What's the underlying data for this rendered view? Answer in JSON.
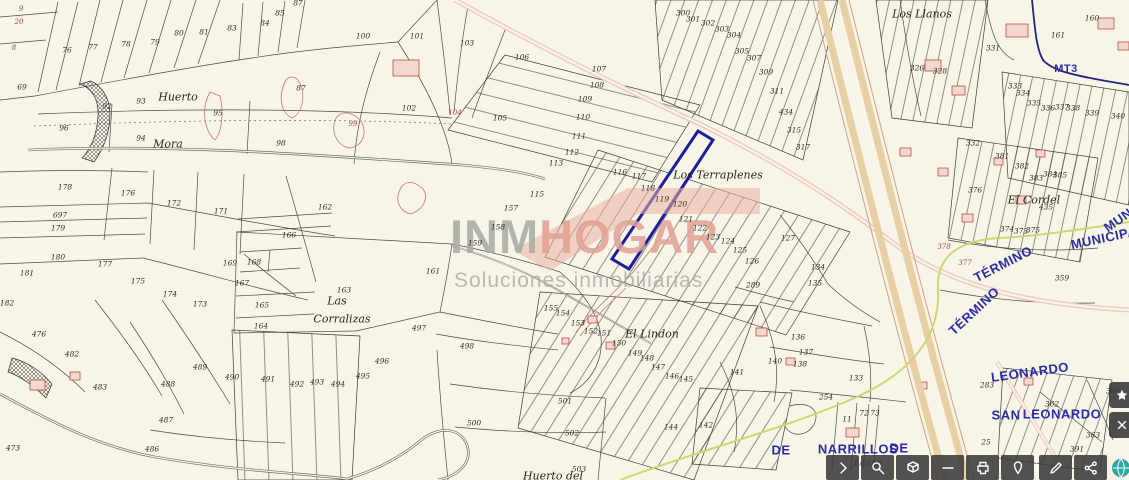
{
  "watermark": {
    "part1": "INM",
    "part2": "HOGAR",
    "subtitle": "Soluciones inmobiliarias",
    "color_gray": "#a6aba3",
    "color_salmon": "#e2a094",
    "roof_color": "#e8b0a4"
  },
  "map": {
    "colors": {
      "background": "#f8f5e8",
      "parcel_line": "#3d3b36",
      "highlight": "#1c1c9e",
      "municipal_boundary": "#24247c",
      "road_pink": "#ddA298",
      "highway_tan": "#e9cfa6",
      "greenway": "#ccd86f",
      "blue_text": "#2b2da8",
      "red_detail": "#b0453c"
    },
    "labels": [
      {
        "t": "9",
        "x": 21,
        "y": 9,
        "c": "r"
      },
      {
        "t": "20",
        "x": 19,
        "y": 22,
        "c": "r"
      },
      {
        "t": "8",
        "x": 14,
        "y": 48,
        "c": "r"
      },
      {
        "t": "69",
        "x": 22,
        "y": 87,
        "c": "n"
      },
      {
        "t": "76",
        "x": 67,
        "y": 50,
        "c": "n"
      },
      {
        "t": "77",
        "x": 93,
        "y": 47,
        "c": "n"
      },
      {
        "t": "78",
        "x": 126,
        "y": 44,
        "c": "n"
      },
      {
        "t": "79",
        "x": 155,
        "y": 42,
        "c": "n"
      },
      {
        "t": "80",
        "x": 179,
        "y": 33,
        "c": "n"
      },
      {
        "t": "81",
        "x": 204,
        "y": 32,
        "c": "n"
      },
      {
        "t": "83",
        "x": 232,
        "y": 28,
        "c": "n"
      },
      {
        "t": "84",
        "x": 265,
        "y": 23,
        "c": "n"
      },
      {
        "t": "85",
        "x": 280,
        "y": 13,
        "c": "n"
      },
      {
        "t": "87",
        "x": 298,
        "y": 3,
        "c": "n"
      },
      {
        "t": "96",
        "x": 64,
        "y": 128,
        "c": "n"
      },
      {
        "t": "92",
        "x": 107,
        "y": 106,
        "c": "n"
      },
      {
        "t": "93",
        "x": 141,
        "y": 101,
        "c": "n"
      },
      {
        "t": "94",
        "x": 141,
        "y": 138,
        "c": "n"
      },
      {
        "t": "95",
        "x": 218,
        "y": 113,
        "c": "n"
      },
      {
        "t": "87",
        "x": 301,
        "y": 88,
        "c": "n"
      },
      {
        "t": "98",
        "x": 281,
        "y": 143,
        "c": "n"
      },
      {
        "t": "99",
        "x": 353,
        "y": 124,
        "c": "r"
      },
      {
        "t": "100",
        "x": 363,
        "y": 36,
        "c": "n"
      },
      {
        "t": "101",
        "x": 417,
        "y": 36,
        "c": "n"
      },
      {
        "t": "102",
        "x": 409,
        "y": 108,
        "c": "n"
      },
      {
        "t": "103",
        "x": 467,
        "y": 43,
        "c": "n"
      },
      {
        "t": "104",
        "x": 455,
        "y": 113,
        "c": "r"
      },
      {
        "t": "105",
        "x": 500,
        "y": 118,
        "c": "n"
      },
      {
        "t": "106",
        "x": 522,
        "y": 57,
        "c": "n"
      },
      {
        "t": "107",
        "x": 599,
        "y": 69,
        "c": "n"
      },
      {
        "t": "108",
        "x": 597,
        "y": 85,
        "c": "n"
      },
      {
        "t": "109",
        "x": 585,
        "y": 99,
        "c": "n"
      },
      {
        "t": "110",
        "x": 583,
        "y": 117,
        "c": "n"
      },
      {
        "t": "111",
        "x": 579,
        "y": 136,
        "c": "n"
      },
      {
        "t": "112",
        "x": 572,
        "y": 152,
        "c": "n"
      },
      {
        "t": "113",
        "x": 556,
        "y": 163,
        "c": "n"
      },
      {
        "t": "115",
        "x": 537,
        "y": 194,
        "c": "n"
      },
      {
        "t": "157",
        "x": 511,
        "y": 208,
        "c": "n"
      },
      {
        "t": "158",
        "x": 498,
        "y": 227,
        "c": "n"
      },
      {
        "t": "159",
        "x": 475,
        "y": 243,
        "c": "n"
      },
      {
        "t": "162",
        "x": 325,
        "y": 207,
        "c": "n"
      },
      {
        "t": "116",
        "x": 620,
        "y": 172,
        "c": "n"
      },
      {
        "t": "117",
        "x": 639,
        "y": 176,
        "c": "n"
      },
      {
        "t": "118",
        "x": 648,
        "y": 188,
        "c": "n"
      },
      {
        "t": "119",
        "x": 662,
        "y": 199,
        "c": "n"
      },
      {
        "t": "120",
        "x": 680,
        "y": 204,
        "c": "n"
      },
      {
        "t": "121",
        "x": 686,
        "y": 219,
        "c": "n"
      },
      {
        "t": "122",
        "x": 700,
        "y": 228,
        "c": "n"
      },
      {
        "t": "123",
        "x": 713,
        "y": 237,
        "c": "n"
      },
      {
        "t": "124",
        "x": 728,
        "y": 241,
        "c": "n"
      },
      {
        "t": "125",
        "x": 740,
        "y": 250,
        "c": "n"
      },
      {
        "t": "126",
        "x": 752,
        "y": 261,
        "c": "n"
      },
      {
        "t": "127",
        "x": 788,
        "y": 238,
        "c": "n"
      },
      {
        "t": "134",
        "x": 818,
        "y": 267,
        "c": "n"
      },
      {
        "t": "135",
        "x": 815,
        "y": 283,
        "c": "n"
      },
      {
        "t": "289",
        "x": 753,
        "y": 285,
        "c": "n"
      },
      {
        "t": "136",
        "x": 798,
        "y": 337,
        "c": "n"
      },
      {
        "t": "137",
        "x": 806,
        "y": 352,
        "c": "n"
      },
      {
        "t": "138",
        "x": 800,
        "y": 364,
        "c": "n"
      },
      {
        "t": "133",
        "x": 856,
        "y": 378,
        "c": "n"
      },
      {
        "t": "300",
        "x": 683,
        "y": 13,
        "c": "n"
      },
      {
        "t": "301",
        "x": 693,
        "y": 19,
        "c": "n"
      },
      {
        "t": "302",
        "x": 708,
        "y": 23,
        "c": "n"
      },
      {
        "t": "303",
        "x": 722,
        "y": 29,
        "c": "n"
      },
      {
        "t": "304",
        "x": 734,
        "y": 35,
        "c": "n"
      },
      {
        "t": "305",
        "x": 742,
        "y": 51,
        "c": "n"
      },
      {
        "t": "307",
        "x": 754,
        "y": 58,
        "c": "n"
      },
      {
        "t": "309",
        "x": 766,
        "y": 72,
        "c": "n"
      },
      {
        "t": "311",
        "x": 777,
        "y": 91,
        "c": "n"
      },
      {
        "t": "434",
        "x": 786,
        "y": 112,
        "c": "n"
      },
      {
        "t": "315",
        "x": 794,
        "y": 130,
        "c": "n"
      },
      {
        "t": "317",
        "x": 803,
        "y": 147,
        "c": "n"
      },
      {
        "t": "326",
        "x": 917,
        "y": 68,
        "c": "n"
      },
      {
        "t": "328",
        "x": 940,
        "y": 71,
        "c": "n"
      },
      {
        "t": "331",
        "x": 993,
        "y": 48,
        "c": "n"
      },
      {
        "t": "160",
        "x": 1092,
        "y": 18,
        "c": "n"
      },
      {
        "t": "161",
        "x": 1058,
        "y": 35,
        "c": "n"
      },
      {
        "t": "333",
        "x": 1015,
        "y": 86,
        "c": "n"
      },
      {
        "t": "334",
        "x": 1023,
        "y": 93,
        "c": "n"
      },
      {
        "t": "335",
        "x": 1034,
        "y": 103,
        "c": "n"
      },
      {
        "t": "336",
        "x": 1048,
        "y": 108,
        "c": "n"
      },
      {
        "t": "337",
        "x": 1062,
        "y": 107,
        "c": "n"
      },
      {
        "t": "338",
        "x": 1073,
        "y": 108,
        "c": "n"
      },
      {
        "t": "339",
        "x": 1092,
        "y": 113,
        "c": "n"
      },
      {
        "t": "340",
        "x": 1118,
        "y": 116,
        "c": "n"
      },
      {
        "t": "332",
        "x": 973,
        "y": 143,
        "c": "n"
      },
      {
        "t": "381",
        "x": 1002,
        "y": 156,
        "c": "n"
      },
      {
        "t": "382",
        "x": 1022,
        "y": 166,
        "c": "n"
      },
      {
        "t": "383",
        "x": 1036,
        "y": 178,
        "c": "n"
      },
      {
        "t": "384",
        "x": 1050,
        "y": 174,
        "c": "n"
      },
      {
        "t": "385",
        "x": 1060,
        "y": 175,
        "c": "n"
      },
      {
        "t": "376",
        "x": 975,
        "y": 190,
        "c": "n"
      },
      {
        "t": "435",
        "x": 1046,
        "y": 207,
        "c": "n"
      },
      {
        "t": "374",
        "x": 1007,
        "y": 229,
        "c": "n"
      },
      {
        "t": "373",
        "x": 1021,
        "y": 231,
        "c": "n"
      },
      {
        "t": "375",
        "x": 1033,
        "y": 230,
        "c": "n"
      },
      {
        "t": "359",
        "x": 1062,
        "y": 278,
        "c": "n"
      },
      {
        "t": "378",
        "x": 944,
        "y": 247,
        "c": "r"
      },
      {
        "t": "377",
        "x": 965,
        "y": 263,
        "c": "r"
      },
      {
        "t": "178",
        "x": 65,
        "y": 187,
        "c": "n"
      },
      {
        "t": "176",
        "x": 128,
        "y": 193,
        "c": "n"
      },
      {
        "t": "172",
        "x": 174,
        "y": 203,
        "c": "n"
      },
      {
        "t": "171",
        "x": 221,
        "y": 211,
        "c": "n"
      },
      {
        "t": "697",
        "x": 60,
        "y": 215,
        "c": "n"
      },
      {
        "t": "179",
        "x": 58,
        "y": 228,
        "c": "n"
      },
      {
        "t": "180",
        "x": 58,
        "y": 257,
        "c": "n"
      },
      {
        "t": "181",
        "x": 27,
        "y": 273,
        "c": "n"
      },
      {
        "t": "182",
        "x": 7,
        "y": 303,
        "c": "n"
      },
      {
        "t": "177",
        "x": 105,
        "y": 264,
        "c": "n"
      },
      {
        "t": "175",
        "x": 138,
        "y": 281,
        "c": "n"
      },
      {
        "t": "174",
        "x": 170,
        "y": 294,
        "c": "n"
      },
      {
        "t": "173",
        "x": 200,
        "y": 304,
        "c": "n"
      },
      {
        "t": "169",
        "x": 230,
        "y": 263,
        "c": "n"
      },
      {
        "t": "168",
        "x": 254,
        "y": 262,
        "c": "n"
      },
      {
        "t": "167",
        "x": 242,
        "y": 283,
        "c": "n"
      },
      {
        "t": "166",
        "x": 289,
        "y": 235,
        "c": "n"
      },
      {
        "t": "165",
        "x": 262,
        "y": 305,
        "c": "n"
      },
      {
        "t": "164",
        "x": 261,
        "y": 326,
        "c": "n"
      },
      {
        "t": "163",
        "x": 344,
        "y": 290,
        "c": "n"
      },
      {
        "t": "161",
        "x": 433,
        "y": 271,
        "c": "n"
      },
      {
        "t": "476",
        "x": 39,
        "y": 334,
        "c": "n"
      },
      {
        "t": "482",
        "x": 72,
        "y": 354,
        "c": "n"
      },
      {
        "t": "483",
        "x": 100,
        "y": 387,
        "c": "n"
      },
      {
        "t": "473",
        "x": 13,
        "y": 448,
        "c": "n"
      },
      {
        "t": "486",
        "x": 152,
        "y": 449,
        "c": "n"
      },
      {
        "t": "487",
        "x": 166,
        "y": 420,
        "c": "n"
      },
      {
        "t": "488",
        "x": 168,
        "y": 384,
        "c": "n"
      },
      {
        "t": "489",
        "x": 200,
        "y": 367,
        "c": "n"
      },
      {
        "t": "490",
        "x": 232,
        "y": 377,
        "c": "n"
      },
      {
        "t": "491",
        "x": 268,
        "y": 379,
        "c": "n"
      },
      {
        "t": "492",
        "x": 297,
        "y": 384,
        "c": "n"
      },
      {
        "t": "493",
        "x": 317,
        "y": 382,
        "c": "n"
      },
      {
        "t": "494",
        "x": 338,
        "y": 384,
        "c": "n"
      },
      {
        "t": "495",
        "x": 363,
        "y": 376,
        "c": "n"
      },
      {
        "t": "496",
        "x": 382,
        "y": 361,
        "c": "n"
      },
      {
        "t": "497",
        "x": 419,
        "y": 328,
        "c": "n"
      },
      {
        "t": "498",
        "x": 467,
        "y": 346,
        "c": "n"
      },
      {
        "t": "500",
        "x": 474,
        "y": 423,
        "c": "n"
      },
      {
        "t": "501",
        "x": 565,
        "y": 401,
        "c": "n"
      },
      {
        "t": "502",
        "x": 572,
        "y": 433,
        "c": "n"
      },
      {
        "t": "503",
        "x": 579,
        "y": 469,
        "c": "n"
      },
      {
        "t": "155",
        "x": 551,
        "y": 308,
        "c": "n"
      },
      {
        "t": "154",
        "x": 563,
        "y": 313,
        "c": "n"
      },
      {
        "t": "153",
        "x": 578,
        "y": 323,
        "c": "n"
      },
      {
        "t": "152",
        "x": 591,
        "y": 331,
        "c": "n"
      },
      {
        "t": "151",
        "x": 604,
        "y": 333,
        "c": "n"
      },
      {
        "t": "150",
        "x": 619,
        "y": 343,
        "c": "n"
      },
      {
        "t": "149",
        "x": 635,
        "y": 353,
        "c": "n"
      },
      {
        "t": "148",
        "x": 647,
        "y": 358,
        "c": "n"
      },
      {
        "t": "147",
        "x": 658,
        "y": 367,
        "c": "n"
      },
      {
        "t": "146",
        "x": 672,
        "y": 376,
        "c": "n"
      },
      {
        "t": "145",
        "x": 686,
        "y": 379,
        "c": "n"
      },
      {
        "t": "144",
        "x": 671,
        "y": 427,
        "c": "n"
      },
      {
        "t": "142",
        "x": 706,
        "y": 425,
        "c": "n"
      },
      {
        "t": "141",
        "x": 737,
        "y": 372,
        "c": "n"
      },
      {
        "t": "140",
        "x": 775,
        "y": 361,
        "c": "n"
      },
      {
        "t": "254",
        "x": 826,
        "y": 397,
        "c": "n"
      },
      {
        "t": "11",
        "x": 847,
        "y": 419,
        "c": "n"
      },
      {
        "t": "72",
        "x": 864,
        "y": 413,
        "c": "n"
      },
      {
        "t": "73",
        "x": 875,
        "y": 413,
        "c": "n"
      },
      {
        "t": "283",
        "x": 987,
        "y": 385,
        "c": "n"
      },
      {
        "t": "25",
        "x": 986,
        "y": 442,
        "c": "n"
      },
      {
        "t": "363",
        "x": 1093,
        "y": 435,
        "c": "n"
      },
      {
        "t": "391",
        "x": 1077,
        "y": 449,
        "c": "n"
      },
      {
        "t": "362",
        "x": 1052,
        "y": 404,
        "c": "n"
      },
      {
        "t": "364",
        "x": 1113,
        "y": 391,
        "c": "n"
      },
      {
        "t": "Huerto",
        "x": 178,
        "y": 97,
        "c": "p"
      },
      {
        "t": "Mora",
        "x": 168,
        "y": 144,
        "c": "p"
      },
      {
        "t": "Las",
        "x": 337,
        "y": 301,
        "c": "p"
      },
      {
        "t": "Corralizas",
        "x": 342,
        "y": 319,
        "c": "p"
      },
      {
        "t": "Los Terraplenes",
        "x": 718,
        "y": 175,
        "c": "p"
      },
      {
        "t": "El Lindon",
        "x": 652,
        "y": 334,
        "c": "p"
      },
      {
        "t": "Los Llanos",
        "x": 922,
        "y": 14,
        "c": "p"
      },
      {
        "t": "El Cordel",
        "x": 1034,
        "y": 200,
        "c": "p"
      },
      {
        "t": "Huerto del",
        "x": 553,
        "y": 476,
        "c": "p"
      },
      {
        "t": "Longa",
        "x": 868,
        "y": 464,
        "c": "t"
      },
      {
        "t": "MT3",
        "x": 1066,
        "y": 69,
        "c": "b",
        "s": 11
      },
      {
        "t": "DE",
        "x": 781,
        "y": 450,
        "c": "b"
      },
      {
        "t": "NARRILLOS",
        "x": 858,
        "y": 449,
        "c": "b"
      },
      {
        "t": "DE",
        "x": 899,
        "y": 448,
        "c": "b"
      },
      {
        "t": "LEONARDO",
        "x": 1030,
        "y": 372,
        "c": "b",
        "r": -8
      },
      {
        "t": "SAN",
        "x": 1006,
        "y": 415,
        "c": "b"
      },
      {
        "t": "LEONARDO",
        "x": 1062,
        "y": 414,
        "c": "b"
      },
      {
        "t": "TÉRMINO",
        "x": 1003,
        "y": 264,
        "c": "b",
        "r": -27
      },
      {
        "t": "MUNICIPAL",
        "x": 1108,
        "y": 237,
        "c": "b",
        "r": -12
      },
      {
        "t": "MUN",
        "x": 1118,
        "y": 220,
        "c": "b",
        "r": -35
      },
      {
        "t": "TÉRMINO",
        "x": 974,
        "y": 311,
        "c": "b",
        "r": -43
      }
    ]
  },
  "toolbar": {
    "buttons": [
      {
        "name": "expand-toolbar-button",
        "icon": "chevron-right-icon"
      },
      {
        "name": "zoom-search-button",
        "icon": "magnifier-icon"
      },
      {
        "name": "layers-cube-button",
        "icon": "cube-icon"
      },
      {
        "name": "measure-button",
        "icon": "minus-icon"
      },
      {
        "name": "print-button",
        "icon": "printer-icon"
      },
      {
        "name": "pin-button",
        "icon": "pin-icon"
      },
      {
        "divider": true
      },
      {
        "name": "edit-button",
        "icon": "pencil-icon"
      },
      {
        "name": "share-button",
        "icon": "share-icon"
      },
      {
        "name": "globe-button",
        "icon": "globe-icon",
        "accent": true,
        "accent_color": "#2aa8a0"
      }
    ]
  },
  "side_controls": [
    {
      "name": "side-control-top",
      "icon": "star-icon"
    },
    {
      "name": "side-control-bottom",
      "icon": "cross-icon"
    }
  ]
}
